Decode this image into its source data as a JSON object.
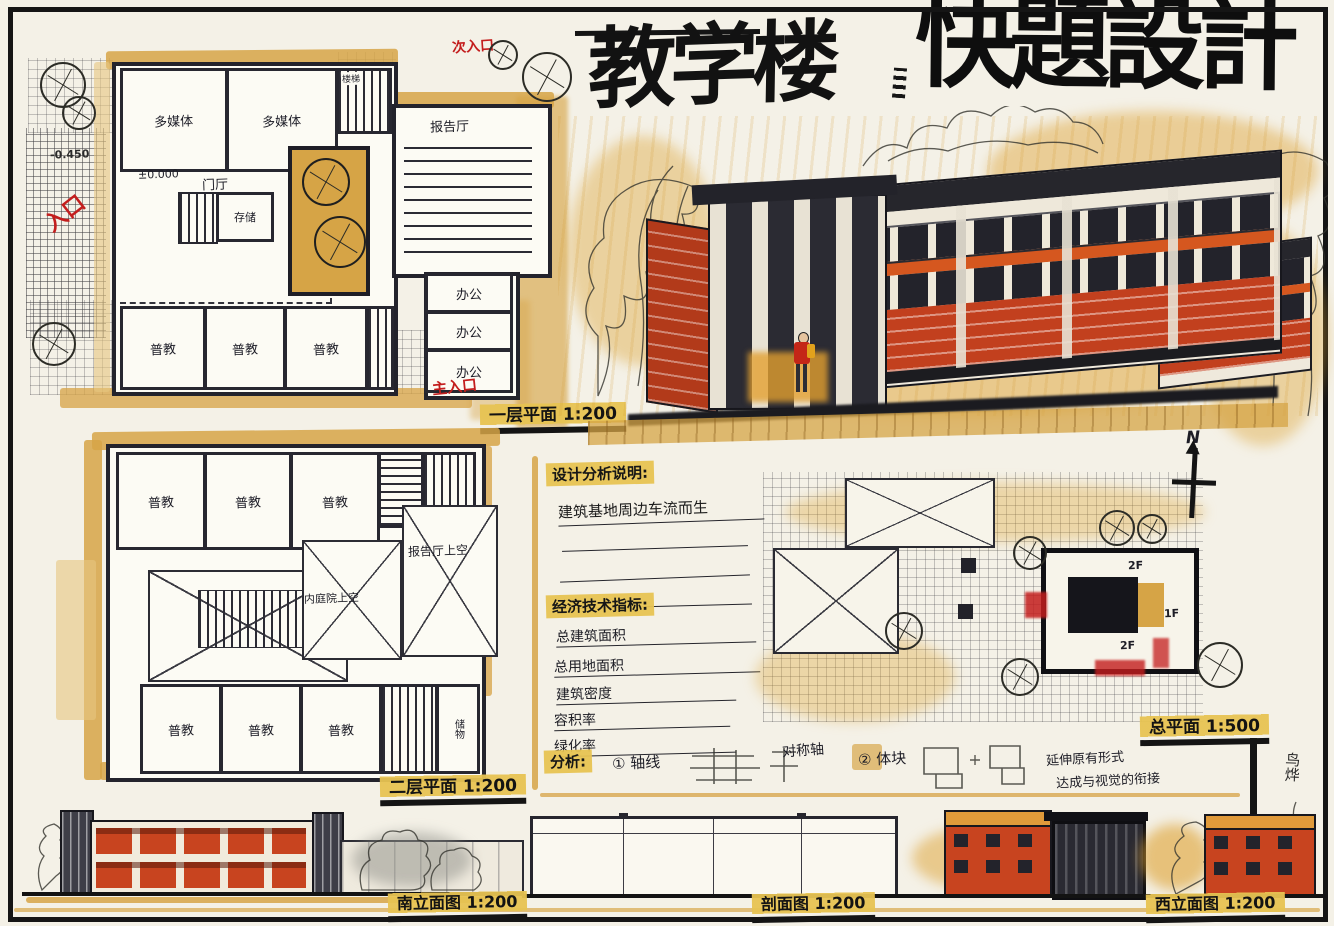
{
  "title": {
    "part1": "教学楼",
    "part2": "快題設計"
  },
  "plan_first": {
    "caption": "一层平面 1:200",
    "rooms": {
      "media": "多媒体",
      "putong": "普教",
      "office": "办公",
      "lecture": "报告厅",
      "hall": "门厅",
      "store": "存储",
      "stair": "楼梯"
    },
    "levels": {
      "zero": "±0.000",
      "neg": "-0.450"
    },
    "entries": {
      "side": "入口",
      "main": "主入口",
      "secondary": "次入口"
    }
  },
  "plan_second": {
    "caption": "二层平面 1:200",
    "rooms": {
      "putong": "普教",
      "stair": "楼梯",
      "storage": "储物"
    },
    "voids": {
      "hall": "门厅上空",
      "court": "内庭院上空",
      "lecture": "报告厅上空"
    }
  },
  "notes": {
    "header_design": "设计分析说明:",
    "design_line1": "建筑基地周边车流而生",
    "header_tech": "经济技术指标:",
    "tech_items": [
      "总建筑面积",
      "总用地面积",
      "建筑密度",
      "容积率",
      "绿化率"
    ],
    "analysis_label": "分析:",
    "axis_item": "① 轴线",
    "axis_note": "对称轴",
    "mass_item": "② 体块",
    "mass_note_line1": "延伸原有形式",
    "mass_note_line2": "达成与视觉的衔接"
  },
  "site": {
    "caption": "总平面 1:500",
    "north_label": "N",
    "floor_2f_a": "2F",
    "floor_1f": "1F",
    "floor_2f_b": "2F"
  },
  "elevations": {
    "south_caption": "南立面图 1:200",
    "section_caption": "剖面图 1:200",
    "west_caption": "西立面图 1:200"
  },
  "signature": "鸟烨",
  "colors": {
    "ink": "#1b1b1b",
    "ochre": "#d6a446",
    "orange_red": "#c2401e",
    "red_note": "#c31d1d",
    "highlight": "#e7c352"
  }
}
